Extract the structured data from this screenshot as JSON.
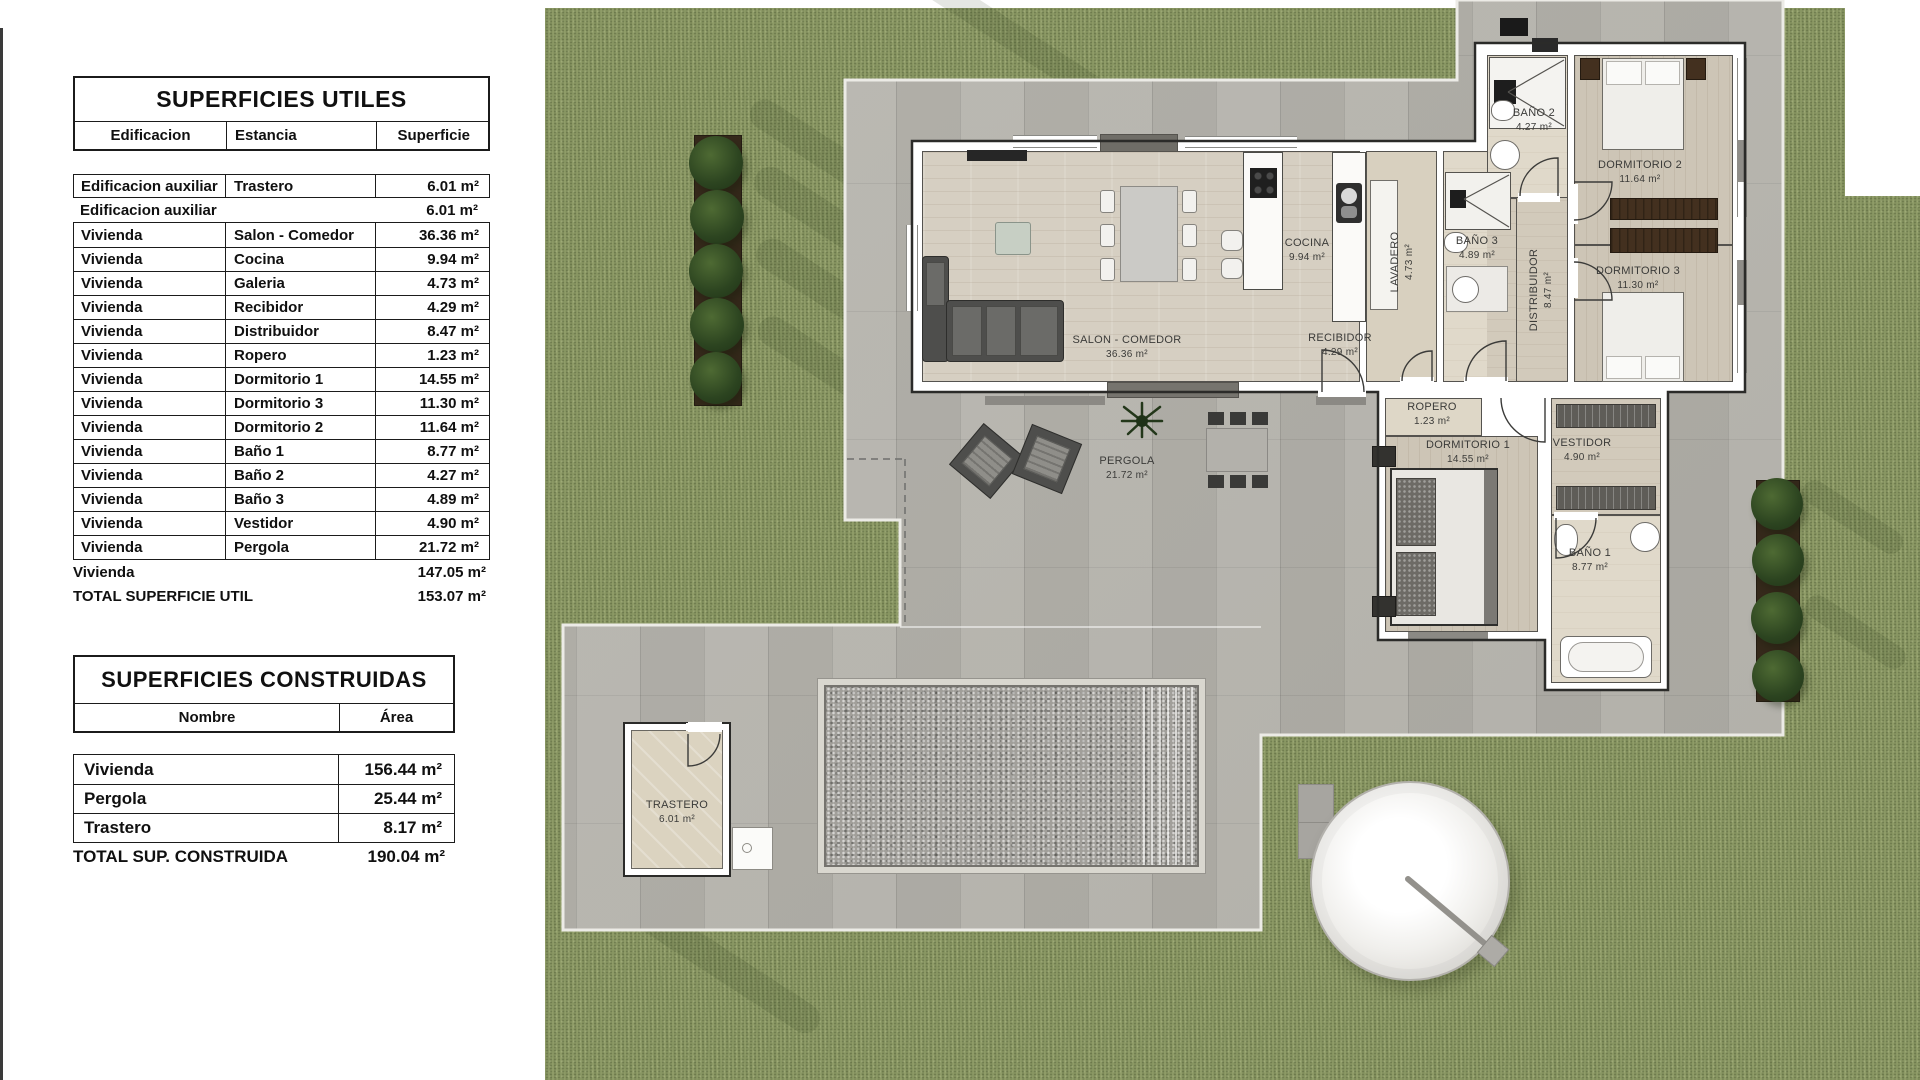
{
  "tables": {
    "utiles": {
      "title": "SUPERFICIES UTILES",
      "columns": [
        "Edificacion",
        "Estancia",
        "Superficie"
      ],
      "rows": [
        {
          "edificacion": "Edificacion auxiliar",
          "estancia": "Trastero",
          "superficie": "6.01 m²"
        },
        {
          "edificacion": "Edificacion auxiliar",
          "estancia": "",
          "superficie": "6.01 m²"
        },
        {
          "edificacion": "Vivienda",
          "estancia": "Salon - Comedor",
          "superficie": "36.36 m²"
        },
        {
          "edificacion": "Vivienda",
          "estancia": "Cocina",
          "superficie": "9.94 m²"
        },
        {
          "edificacion": "Vivienda",
          "estancia": "Galeria",
          "superficie": "4.73 m²"
        },
        {
          "edificacion": "Vivienda",
          "estancia": "Recibidor",
          "superficie": "4.29 m²"
        },
        {
          "edificacion": "Vivienda",
          "estancia": "Distribuidor",
          "superficie": "8.47 m²"
        },
        {
          "edificacion": "Vivienda",
          "estancia": "Ropero",
          "superficie": "1.23 m²"
        },
        {
          "edificacion": "Vivienda",
          "estancia": "Dormitorio 1",
          "superficie": "14.55 m²"
        },
        {
          "edificacion": "Vivienda",
          "estancia": "Dormitorio 3",
          "superficie": "11.30 m²"
        },
        {
          "edificacion": "Vivienda",
          "estancia": "Dormitorio 2",
          "superficie": "11.64 m²"
        },
        {
          "edificacion": "Vivienda",
          "estancia": "Baño 1",
          "superficie": "8.77 m²"
        },
        {
          "edificacion": "Vivienda",
          "estancia": "Baño 2",
          "superficie": "4.27 m²"
        },
        {
          "edificacion": "Vivienda",
          "estancia": "Baño 3",
          "superficie": "4.89 m²"
        },
        {
          "edificacion": "Vivienda",
          "estancia": "Vestidor",
          "superficie": "4.90 m²"
        },
        {
          "edificacion": "Vivienda",
          "estancia": "Pergola",
          "superficie": "21.72 m²"
        }
      ],
      "summary_rows": [
        {
          "label": "Vivienda",
          "value": "147.05 m²"
        },
        {
          "label": "TOTAL SUPERFICIE UTIL",
          "value": "153.07 m²"
        }
      ]
    },
    "construidas": {
      "title": "SUPERFICIES CONSTRUIDAS",
      "columns": [
        "Nombre",
        "Área"
      ],
      "rows": [
        {
          "nombre": "Vivienda",
          "area": "156.44 m²"
        },
        {
          "nombre": "Pergola",
          "area": "25.44 m²"
        },
        {
          "nombre": "Trastero",
          "area": "8.17 m²"
        }
      ],
      "total": {
        "label": "TOTAL SUP. CONSTRUIDA",
        "value": "190.04 m²"
      }
    }
  },
  "plan": {
    "rooms": [
      {
        "name": "SALON - COMEDOR",
        "area": "36.36 m²"
      },
      {
        "name": "COCINA",
        "area": "9.94 m²"
      },
      {
        "name": "LAVADERO",
        "area": "4.73 m²"
      },
      {
        "name": "BAÑO 3",
        "area": "4.89 m²"
      },
      {
        "name": "DISTRIBUIDOR",
        "area": "8.47 m²"
      },
      {
        "name": "BAÑO 2",
        "area": "4.27 m²"
      },
      {
        "name": "DORMITORIO 2",
        "area": "11.64 m²"
      },
      {
        "name": "DORMITORIO 3",
        "area": "11.30 m²"
      },
      {
        "name": "RECIBIDOR",
        "area": "4.29 m²"
      },
      {
        "name": "ROPERO",
        "area": "1.23 m²"
      },
      {
        "name": "DORMITORIO 1",
        "area": "14.55 m²"
      },
      {
        "name": "VESTIDOR",
        "area": "4.90 m²"
      },
      {
        "name": "BAÑO 1",
        "area": "8.77 m²"
      },
      {
        "name": "PERGOLA",
        "area": "21.72 m²"
      },
      {
        "name": "TRASTERO",
        "area": "6.01 m²"
      }
    ],
    "colors": {
      "grass": "#8f9c68",
      "paving": "#b6b4ad",
      "wood": "#d6cfc2",
      "wall": "#ffffff",
      "line": "#2b2b29"
    }
  }
}
